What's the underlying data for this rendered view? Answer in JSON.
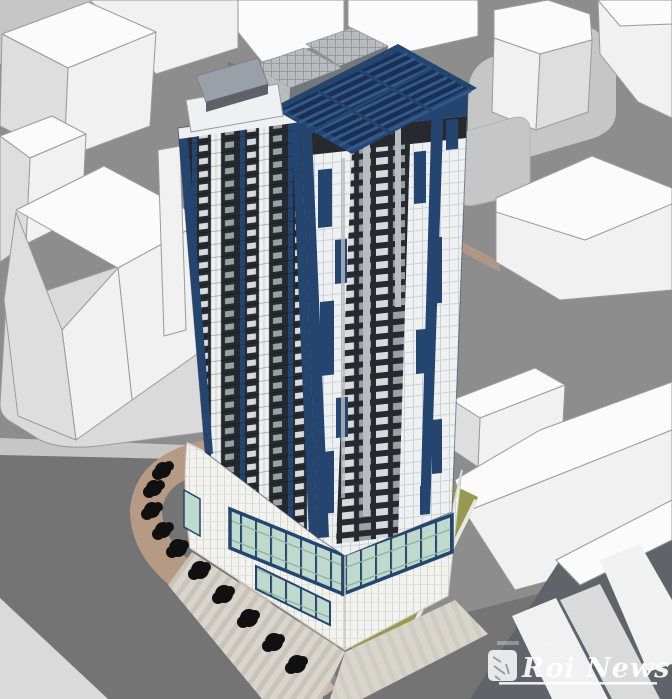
{
  "watermark": {
    "brand": "Roi News",
    "small_text": "로이뉴스"
  },
  "colors": {
    "ground": "#8d8d8d",
    "road": "#747474",
    "road-dark": "#60646a",
    "walk": "#c6c6c6",
    "walk-light": "#dadada",
    "building-top": "#fbfbfb",
    "building-side": "#f1f1f1",
    "building-shade": "#dededf",
    "edge": "#9a9a9a",
    "navy": "#24456f",
    "navy-deep": "#1a2f52",
    "navy-mid": "#31598c",
    "facade-dark": "#26292e",
    "window-light": "#d8dbdd",
    "window-dim": "#9aa0a6",
    "tile": "#eef0f1",
    "tile-line": "#c8cfd4",
    "glass": "#bfdacd",
    "glass-line": "#8fb4a2",
    "canopy": "#9aa0a8",
    "canopy-dark": "#5d6269",
    "grey-box": "#b9bcbe",
    "grey-dark": "#74787c",
    "post": "#b9bdc2",
    "tan": "#b79a84",
    "tan-light": "#cdb6a2",
    "olive": "#97994f",
    "tree": "#101010",
    "stripe-a": "#d9d5cc",
    "stripe-b": "#c8c4bb",
    "watermark": "#ffffff"
  }
}
